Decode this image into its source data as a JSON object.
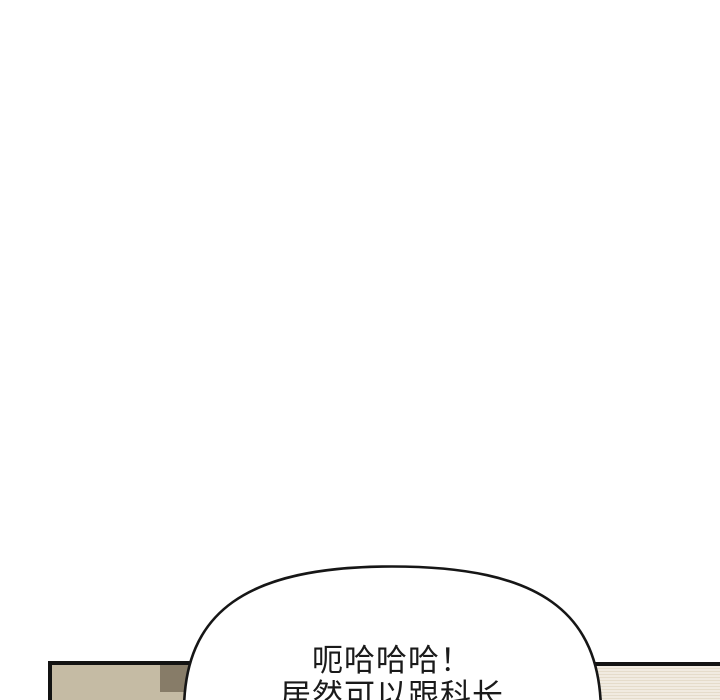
{
  "page": {
    "background_color": "#ffffff",
    "type": "comic-strip-segment"
  },
  "speech_bubble": {
    "text_lines": [
      "呃哈哈哈！",
      "居然可以跟科长"
    ],
    "fill_color": "#ffffff",
    "outline_color": "#161616",
    "text_color": "#1a1a1a"
  },
  "bottom_panels": {
    "left": {
      "fill_color": "#c5bba4",
      "dark_square_color": "#877c68",
      "border_color": "#131313"
    },
    "right": {
      "fill_color": "#f1ebe1",
      "stripe_color": "#e5dccb",
      "border_color": "#131313"
    }
  }
}
